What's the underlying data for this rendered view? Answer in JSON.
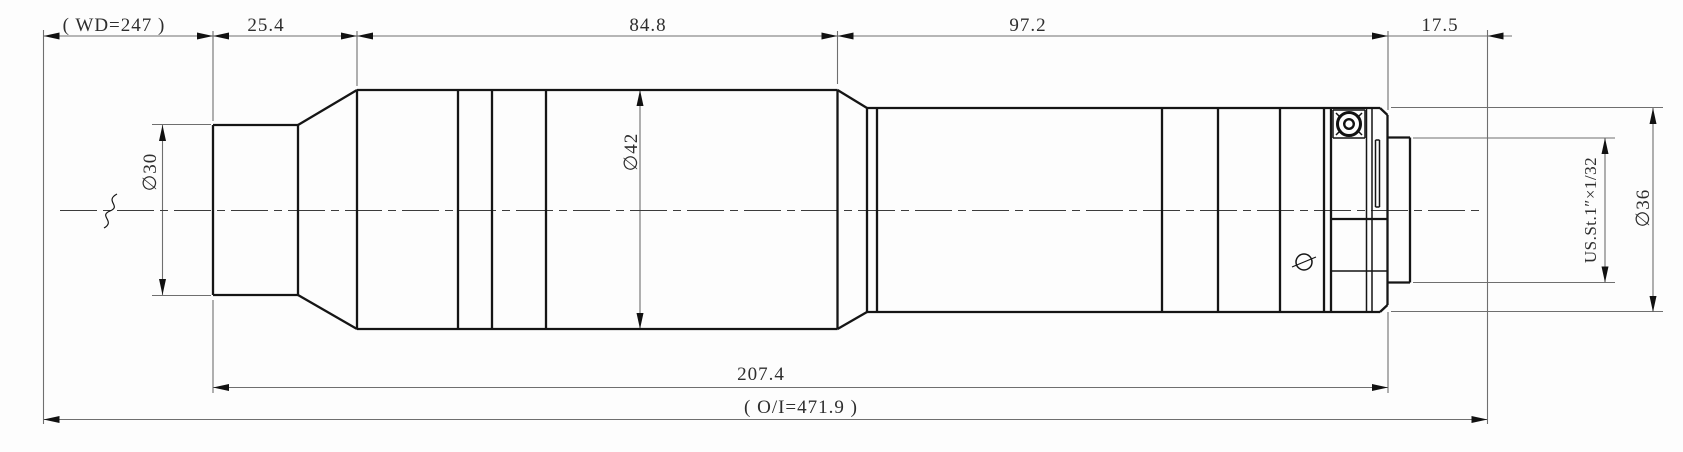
{
  "drawing": {
    "kind": "mechanical outline drawing, side view of cylindrical lens assembly",
    "dimensions": {
      "working_distance": {
        "label": "( WD=247 )",
        "value": 247,
        "orientation": "horizontal"
      },
      "front_length": {
        "label": "25.4",
        "value": 25.4,
        "orientation": "horizontal"
      },
      "mid_length": {
        "label": "84.8",
        "value": 84.8,
        "orientation": "horizontal"
      },
      "rear_length": {
        "label": "97.2",
        "value": 97.2,
        "orientation": "horizontal"
      },
      "flange_to_image": {
        "label": "17.5",
        "value": 17.5,
        "orientation": "horizontal"
      },
      "mechanical_length": {
        "label": "207.4",
        "value": 207.4,
        "orientation": "horizontal"
      },
      "object_to_image": {
        "label": "( O/I=471.9 )",
        "value": 471.9,
        "orientation": "horizontal"
      },
      "front_diameter": {
        "label": "∅30",
        "value": 30,
        "orientation": "vertical"
      },
      "body_diameter": {
        "label": "∅42",
        "value": 42,
        "orientation": "vertical"
      },
      "rear_diameter": {
        "label": "∅36",
        "value": 36,
        "orientation": "vertical"
      },
      "mount_thread": {
        "label": "US.St.1″×1/32",
        "orientation": "vertical"
      }
    }
  }
}
